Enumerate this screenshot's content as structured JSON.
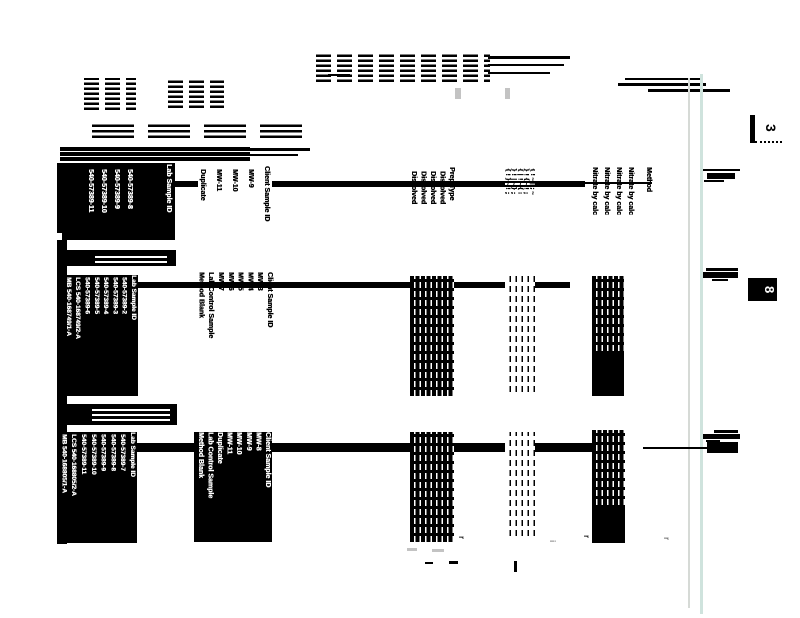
{
  "tabs": {
    "top": "3",
    "bottom": "8"
  },
  "table1": {
    "lab": {
      "header": "Lab Sample ID",
      "rows": [
        "540-57389-8",
        "540-57389-9",
        "540-57389-10",
        "540-57389-11"
      ]
    },
    "client": {
      "header": "Client Sample ID",
      "rows": [
        "MW-9",
        "MW-10",
        "MW-11",
        "Duplicate"
      ]
    },
    "prep": {
      "header": "Prep Type",
      "rows": [
        "Dissolved",
        "Dissolved",
        "Dissolved",
        "Dissolved"
      ]
    },
    "dates": {
      "rows": [
        "{!~|;~",
        "}!{~!;",
        "{|!~{:",
        "}!|~};",
        "{!}~!;"
      ]
    },
    "method": {
      "header": "Method",
      "rows": [
        "Nitrate by calc",
        "Nitrate by calc",
        "Nitrate by calc",
        "Nitrate by calc"
      ]
    }
  },
  "table2": {
    "lab": {
      "header": "Lab Sample ID",
      "rows": [
        "540-57389-2",
        "540-57389-3",
        "540-57389-4",
        "540-57389-5",
        "540-57389-6",
        "LCS 540-168749/2-A",
        "MB 540-168749/1-A"
      ]
    },
    "client": {
      "header": "Client Sample ID",
      "rows": [
        "MW-3",
        "MW-4",
        "MW-5",
        "MW-6",
        "MW-7",
        "Lab Control Sample",
        "Method Blank"
      ]
    }
  },
  "table3": {
    "lab": {
      "header": "Lab Sample ID",
      "rows": [
        "540-57389-7",
        "540-57389-8",
        "540-57389-9",
        "540-57389-10",
        "540-57389-11",
        "LCS 540-168805/2-A",
        "MB 540-168805/1-A"
      ]
    },
    "client": {
      "header": "Client Sample ID",
      "rows": [
        "MW-8",
        "MW-9",
        "MW-10",
        "MW-11",
        "Duplicate",
        "Lab Control Sample",
        "Method Blank"
      ]
    }
  }
}
